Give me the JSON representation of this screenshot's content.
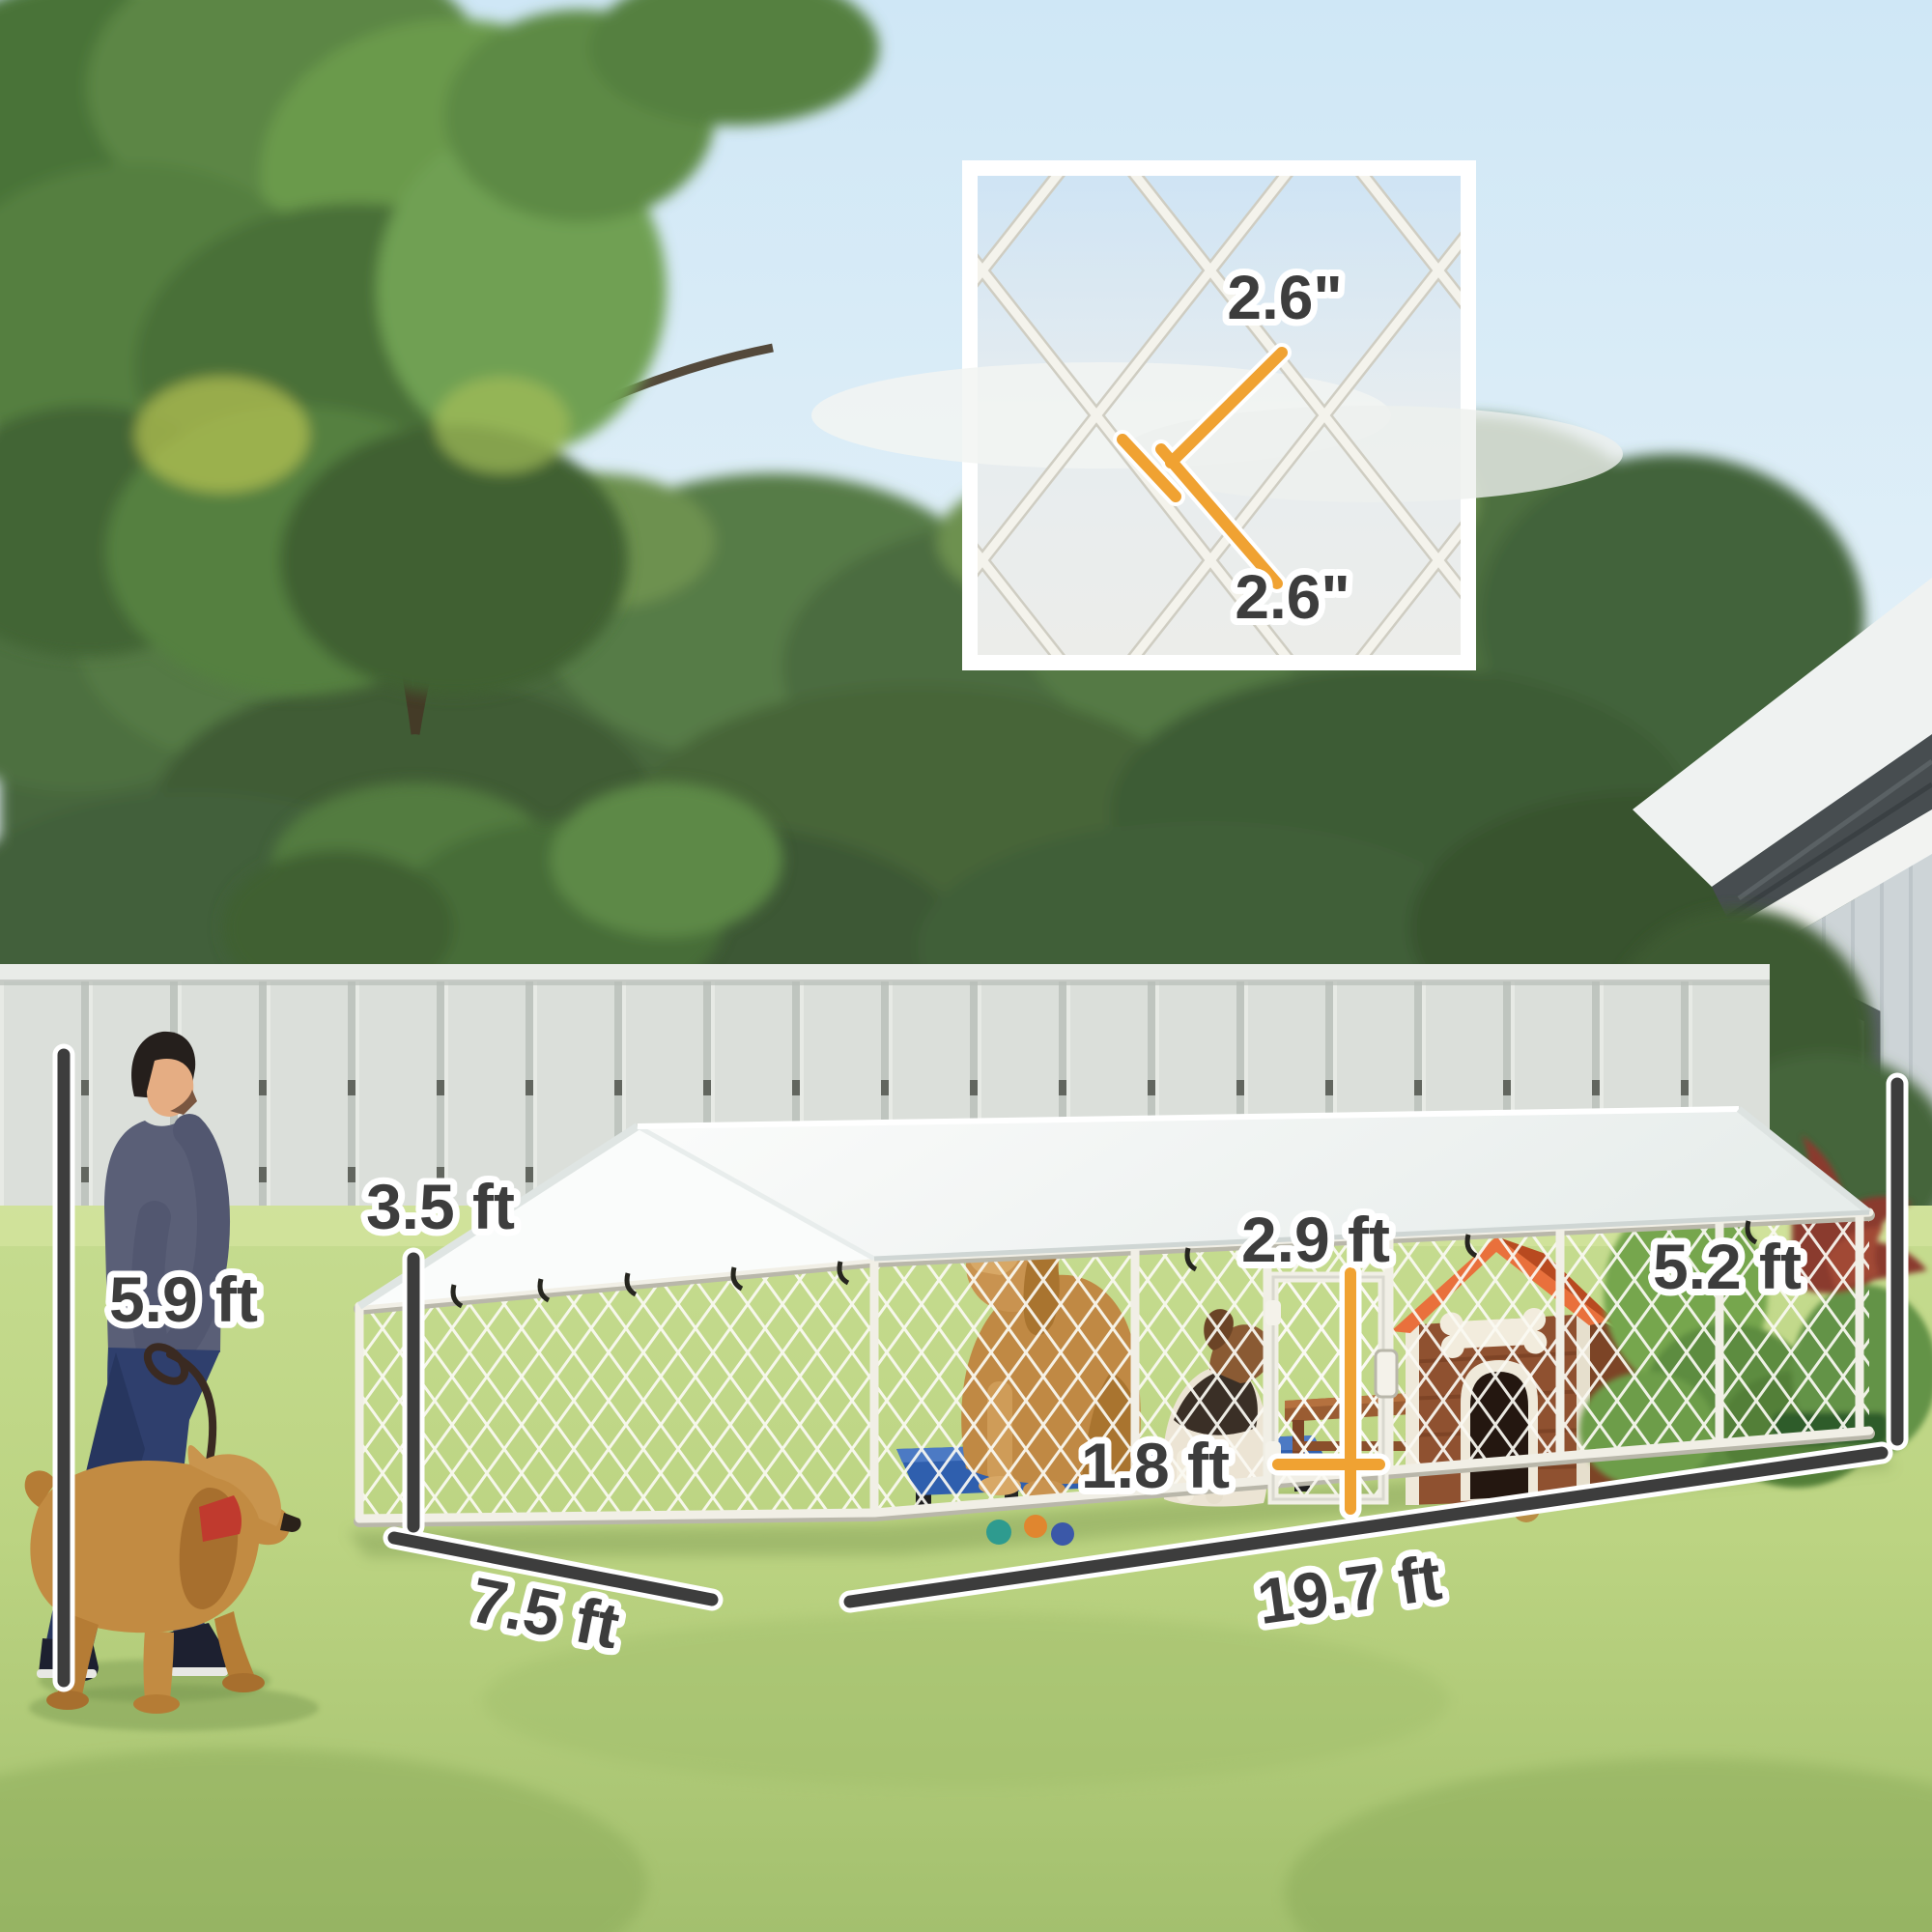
{
  "measurements": {
    "left_height": "5.9 ft",
    "roof_rise": "3.5 ft",
    "depth": "7.5 ft",
    "length": "19.7 ft",
    "gate_height": "2.9 ft",
    "gate_width": "1.8 ft",
    "right_height": "5.2 ft",
    "mesh_opening_top": "2.6\"",
    "mesh_opening_bottom": "2.6\""
  },
  "colors": {
    "accent_orange": "#F0A232",
    "annotation_gray": "#3D3D3D",
    "canopy_white": "#F3F5F4",
    "doghouse_roof": "#D65C2C",
    "grass_green": "#BCD482",
    "sky_blue": "#CFE7F6"
  }
}
